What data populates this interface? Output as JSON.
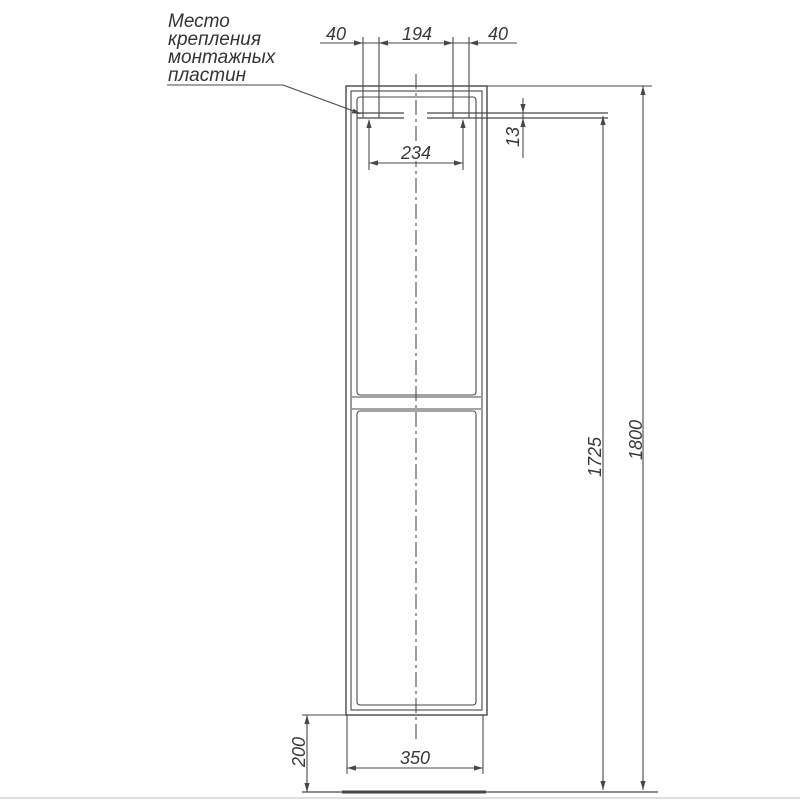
{
  "note": {
    "lines": [
      "Место",
      "крепления",
      "монтажных",
      "пластин"
    ]
  },
  "dims": {
    "left_offset": "40",
    "center_span": "194",
    "right_offset": "40",
    "plate_spacing": "234",
    "plate_thickness": "13",
    "plate_height_from_floor": "1725",
    "total_height": "1800",
    "floor_clearance": "200",
    "width": "350"
  },
  "colors": {
    "line": "#474747",
    "text": "#383838",
    "background": "#ffffff"
  }
}
